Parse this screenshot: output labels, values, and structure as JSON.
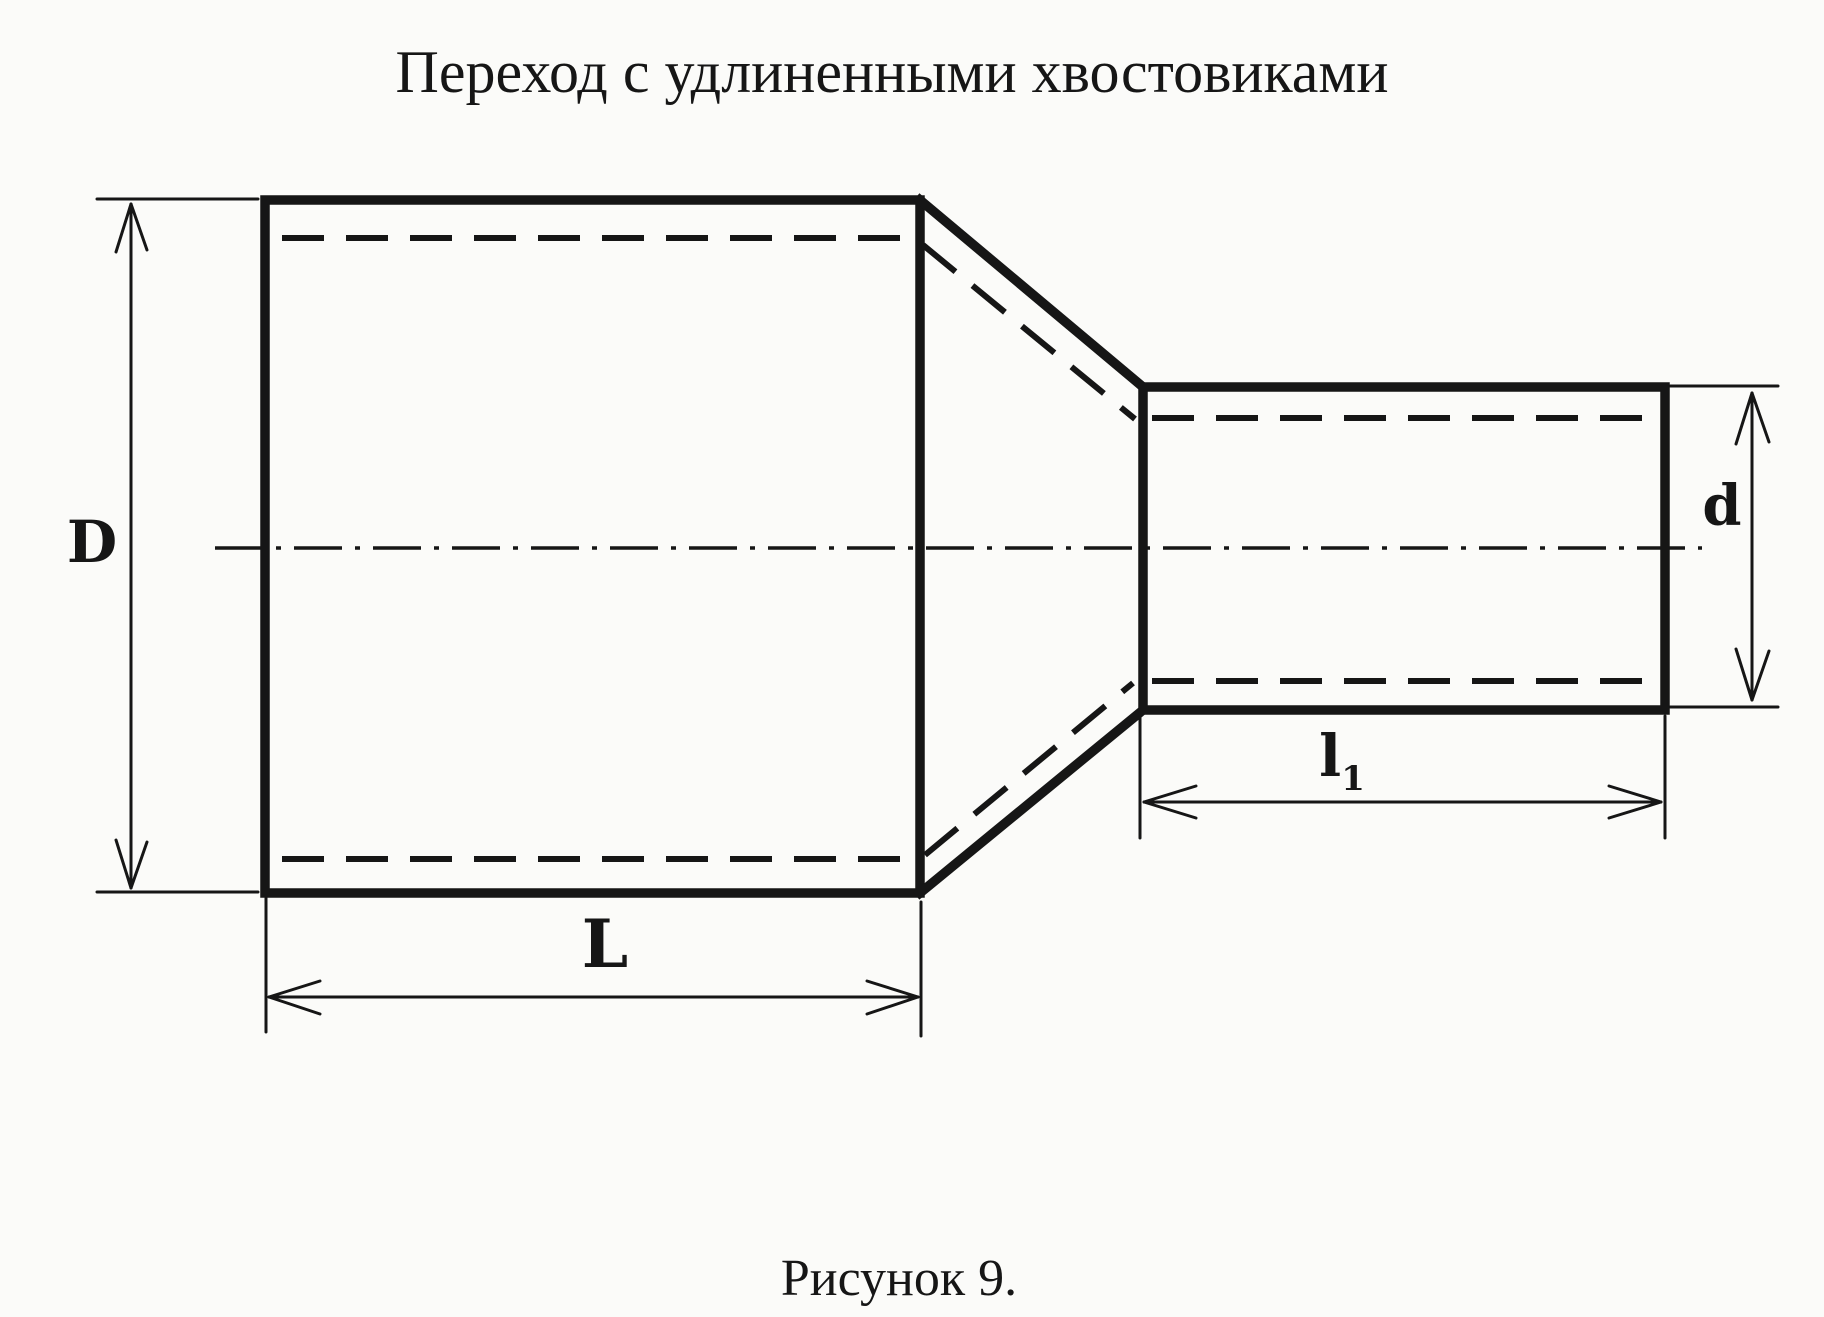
{
  "title": "Переход с удлиненными хвостовиками",
  "caption": "Рисунок 9.",
  "labels": {
    "big_diameter": "D",
    "small_diameter": "d",
    "big_length": "L",
    "small_length_base": "l",
    "small_length_sub": "1"
  },
  "colors": {
    "ink": "#161616",
    "background": "#fbfbf9"
  }
}
